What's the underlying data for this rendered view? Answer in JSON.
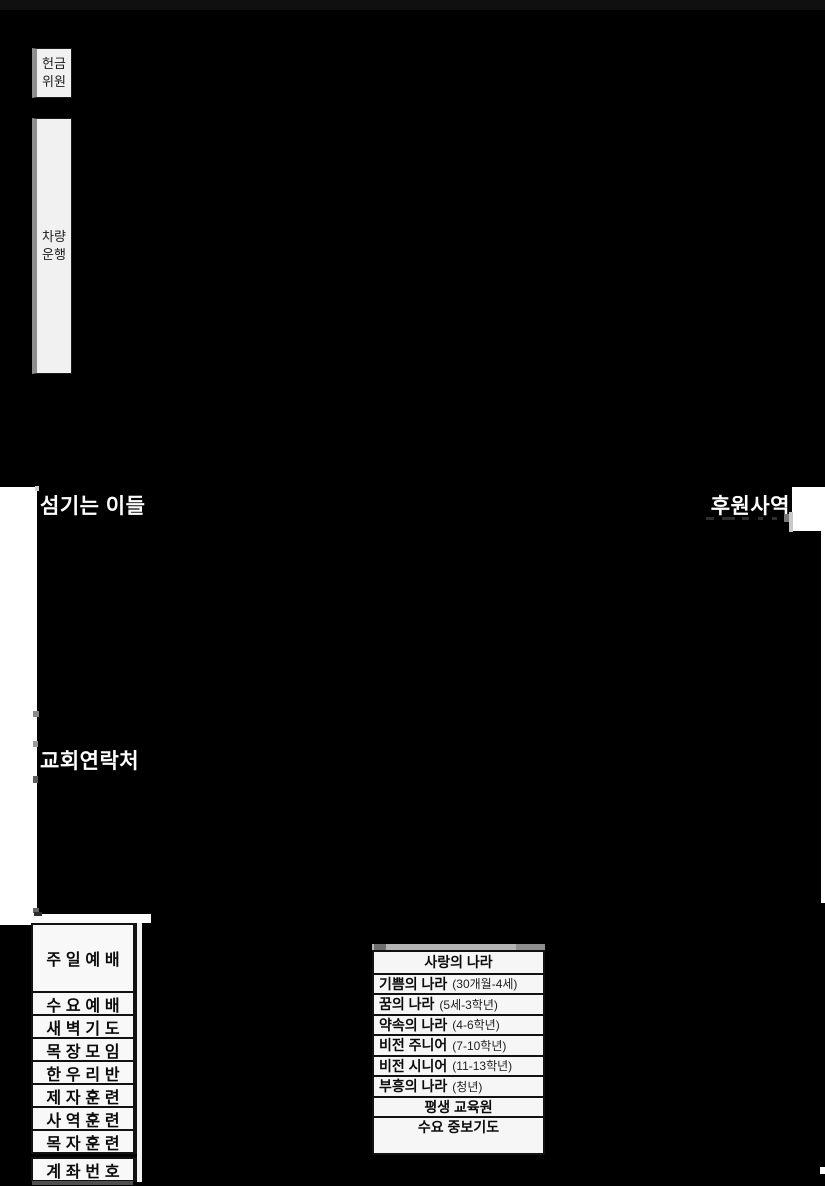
{
  "colors": {
    "background": "#000000",
    "paper": "#f4f4f4",
    "ink": "#111111",
    "header_text": "#ffffff"
  },
  "side_boxes": {
    "offering": {
      "line1": "헌금",
      "line2": "위원"
    },
    "vehicle": {
      "line1": "차량",
      "line2": "운행"
    }
  },
  "section_labels": {
    "serving": "섬기는 이들",
    "support": "후원사역",
    "contact": "교회연락처"
  },
  "schedule_table": {
    "rows": [
      "주일예배",
      "수요예배",
      "새벽기도",
      "목장모임",
      "한우리반",
      "제자훈련",
      "사역훈련",
      "목자훈련"
    ],
    "account_row": "계좌번호"
  },
  "ministry_table": {
    "header": "사랑의 나라",
    "rows": [
      {
        "name": "기쁨의 나라",
        "detail": "(30개월-4세)"
      },
      {
        "name": "꿈의 나라",
        "detail": "(5세-3학년)"
      },
      {
        "name": "약속의 나라",
        "detail": "(4-6학년)"
      },
      {
        "name": "비전 주니어",
        "detail": "(7-10학년)"
      },
      {
        "name": "비전 시니어",
        "detail": "(11-13학년)"
      },
      {
        "name": "부흥의 나라",
        "detail": "(청년)"
      }
    ],
    "footer_rows": [
      "평생 교육원",
      "수요 중보기도"
    ]
  }
}
